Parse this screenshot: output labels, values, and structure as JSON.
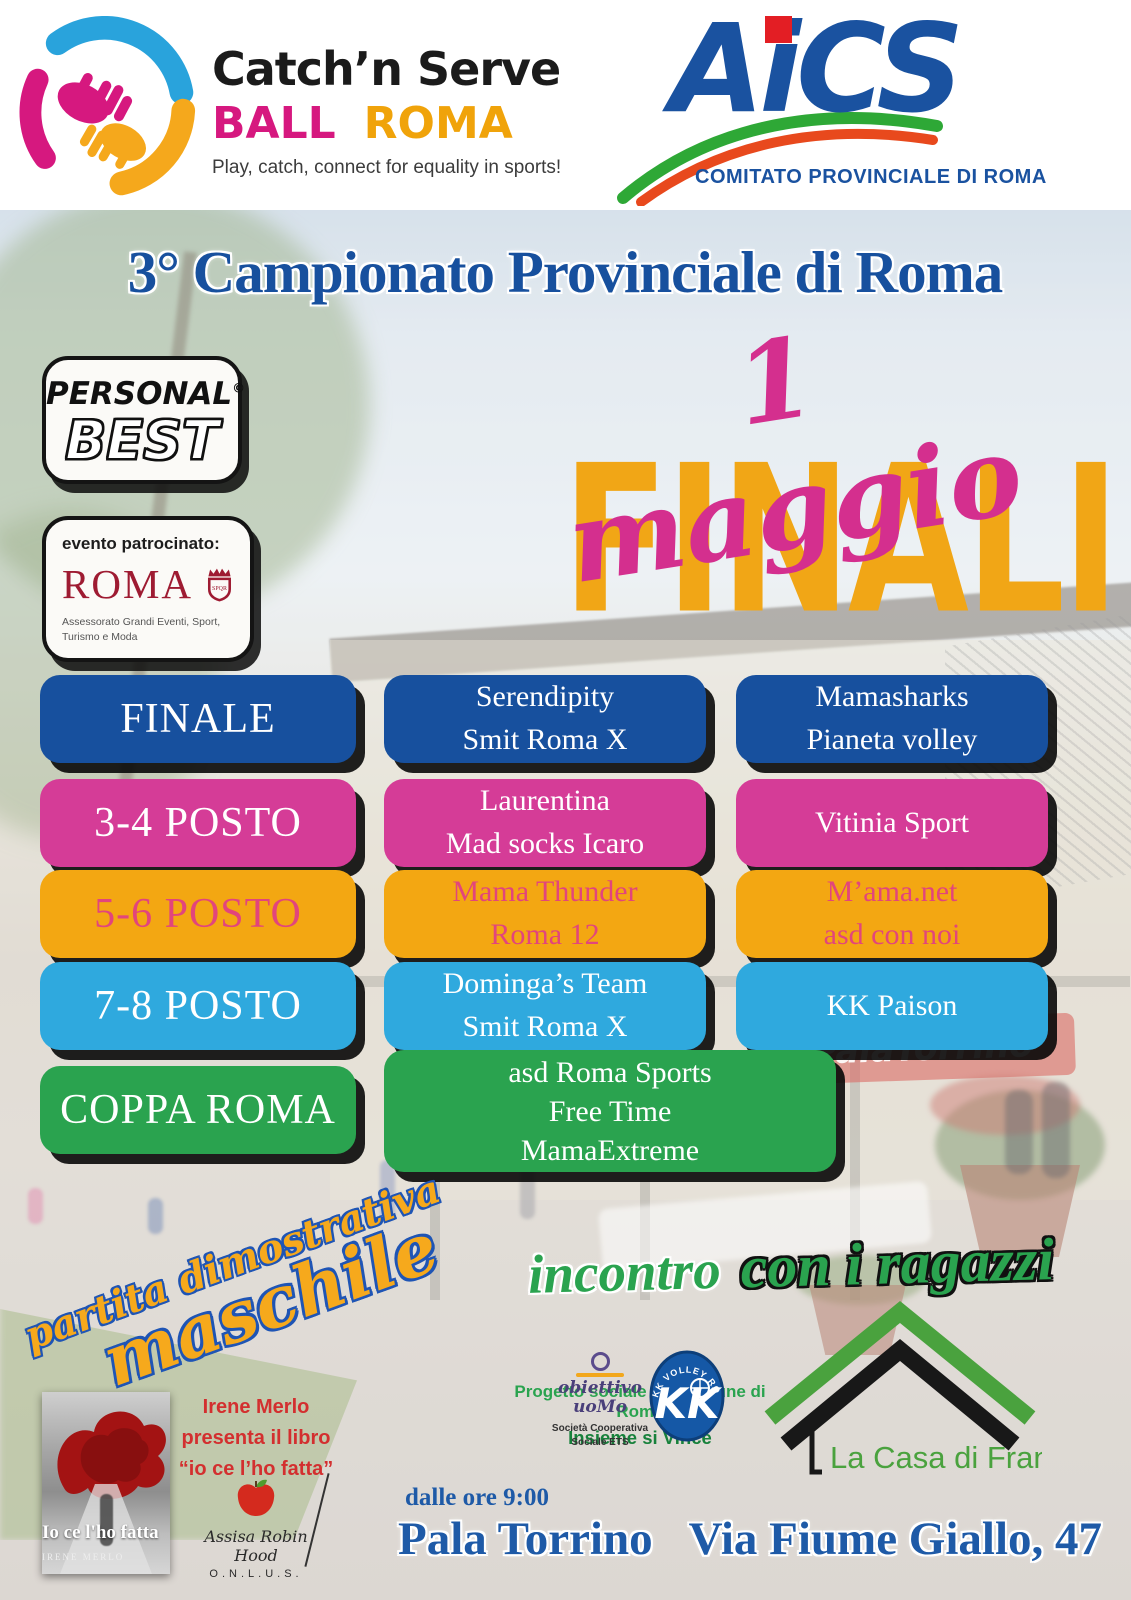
{
  "colors": {
    "title_blue": "#17509e",
    "date_pink": "#d42f8e",
    "finali_yellow": "#f1a616",
    "row_blue": "#17509e",
    "row_pink": "#d53c97",
    "row_orange": "#f3a712",
    "row_orange_text": "#e2457c",
    "row_cyan": "#2fa9de",
    "row_green": "#2aa34f",
    "brand_ball_pink": "#d6187f",
    "brand_roma_orange": "#f0a30a",
    "aics_blue": "#1a52a0",
    "aics_red": "#e31e24",
    "patronage_red": "#9e1b32",
    "promo_red": "#d32f2f",
    "footer_blue": "#1e5aa7"
  },
  "header": {
    "csb": {
      "title": "Catch’n Serve",
      "ball": "BALL",
      "roma": "ROMA",
      "tagline": "Play, catch, connect for equality in sports!"
    },
    "aics": {
      "acronym": "AiCS",
      "part_a": "A",
      "part_i": "i",
      "part_cs": "CS",
      "subtitle": "COMITATO PROVINCIALE DI ROMA"
    }
  },
  "hero": {
    "title": "3° Campionato Provinciale di Roma",
    "date": "1 maggio",
    "finali": "FINALI"
  },
  "badges": {
    "personal_best": {
      "line1": "PERSONAL",
      "mark": "©",
      "line2": "BEST"
    },
    "patronage": {
      "label": "evento patrocinato:",
      "city": "ROMA",
      "caption1": "Assessorato Grandi Eventi, Sport,",
      "caption2": "Turismo e Moda"
    }
  },
  "bracket": {
    "rows": [
      {
        "label": "FINALE",
        "color": "#17509e",
        "cells": [
          {
            "lines": [
              "Serendipity",
              "Smit Roma X"
            ]
          },
          {
            "lines": [
              "Mamasharks",
              "Pianeta volley"
            ]
          }
        ]
      },
      {
        "label": "3-4 POSTO",
        "color": "#d53c97",
        "cells": [
          {
            "lines": [
              "Laurentina",
              "Mad socks Icaro"
            ]
          },
          {
            "lines": [
              "Vitinia Sport"
            ]
          }
        ]
      },
      {
        "label": "5-6 POSTO",
        "color": "#f3a712",
        "text_color": "#e2457c",
        "cells": [
          {
            "lines": [
              "Mama Thunder",
              "Roma 12"
            ]
          },
          {
            "lines": [
              "M’ama.net",
              "asd con noi"
            ]
          }
        ]
      },
      {
        "label": "7-8 POSTO",
        "color": "#2fa9de",
        "cells": [
          {
            "lines": [
              "Dominga’s Team",
              "Smit Roma X"
            ]
          },
          {
            "lines": [
              "KK Paison"
            ]
          }
        ]
      },
      {
        "label": "COPPA ROMA",
        "color": "#2aa34f",
        "cells": [
          {
            "lines": [
              "asd Roma Sports",
              "Free Time",
              "MamaExtreme"
            ]
          }
        ]
      }
    ]
  },
  "photo": {
    "sign": "PalaTorrino"
  },
  "demo_match": {
    "line1": "partita dimostrativa",
    "line2": "maschile"
  },
  "meeting": {
    "word1": "incontro",
    "word2": "con i ragazzi"
  },
  "social_project": {
    "line1": "Progetto sociale del comune di Roma",
    "line2": "Insieme si Vince"
  },
  "partner_logos": {
    "obiettivo_uomo": {
      "line1": "obiettivo",
      "line2": "uoMo",
      "caption1": "Società Cooperativa",
      "caption2": "Sociale ETS"
    },
    "kk_volley": {
      "arc_text": "KK VOLLEY ROMA",
      "monogram": "KK"
    },
    "casa_di_franco": {
      "label": "La Casa di Franco"
    }
  },
  "book_promo": {
    "line1": "Irene Merlo",
    "line2": "presenta il libro",
    "line3": "“io ce l’ho fatta”"
  },
  "book_cover": {
    "title": "Io ce l'ho fatta",
    "author": "IRENE MERLO"
  },
  "onlus": {
    "name": "Assisa Robin Hood",
    "suffix": "O.N.L.U.S."
  },
  "footer": {
    "time": "dalle ore 9:00",
    "venue_name": "Pala Torrino",
    "venue_address": "Via Fiume Giallo, 47"
  }
}
